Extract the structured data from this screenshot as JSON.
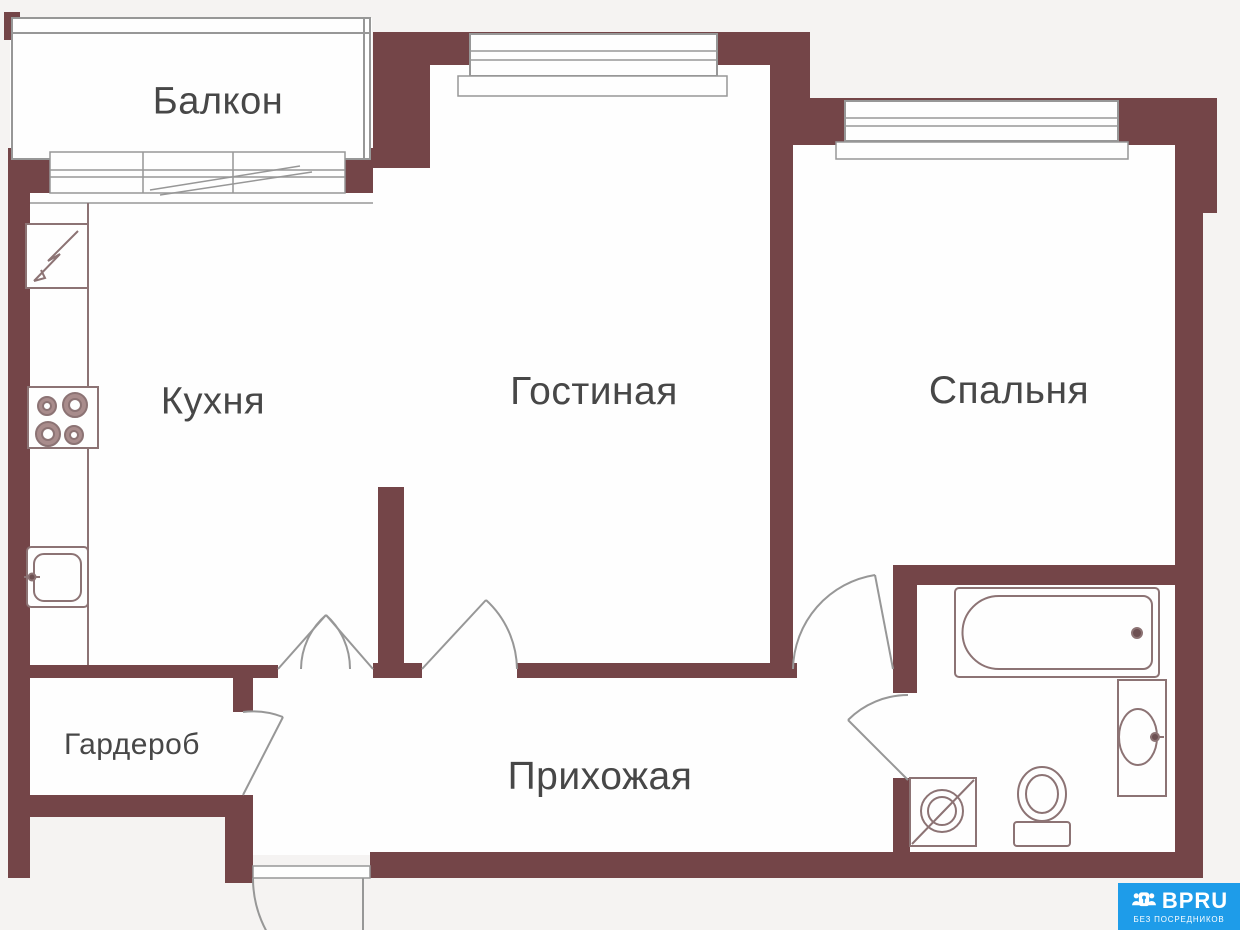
{
  "plan": {
    "rooms": {
      "balcony": "Балкон",
      "kitchen": "Кухня",
      "living": "Гостиная",
      "bedroom": "Спальня",
      "wardrobe": "Гардероб",
      "hallway": "Прихожая"
    },
    "fixture_icons": [
      "fridge-icon",
      "stove-icon",
      "kitchen-sink-icon",
      "bathtub-icon",
      "washbasin-icon",
      "toilet-icon",
      "washing-machine-icon",
      "balcony-slider-window-icon",
      "window-icon",
      "door-swing-arc-icon"
    ]
  },
  "branding": {
    "logo_text": "BPRU",
    "tagline": "БЕЗ ПОСРЕДНИКОВ"
  },
  "colors": {
    "wall": "#744548",
    "line": "#979797",
    "fixture": "#8c7374",
    "label": "#474747",
    "logo_bg": "#1e9ce9",
    "outside_bg": "#f5f3f2",
    "room_bg": "#fefefe"
  }
}
